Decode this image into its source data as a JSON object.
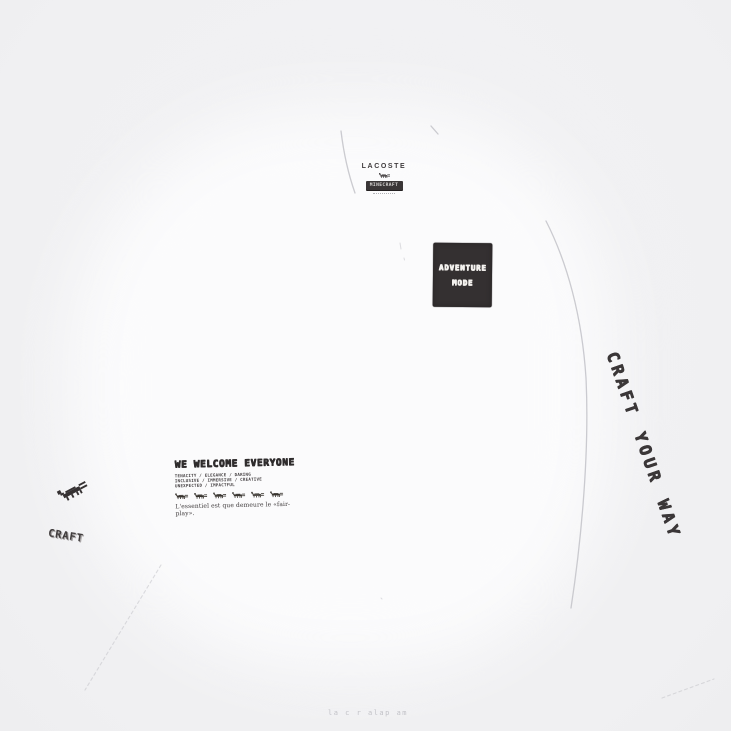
{
  "scene": {
    "background_color": "#f1f1f3",
    "shirt_color": "#fbfbfc",
    "ink_color": "#373334",
    "seam_color": "#c3c3c9"
  },
  "brand_lockup": {
    "wordmark": "LACOSTE",
    "collab_logo": "MINECRAFT"
  },
  "adventure_patch": {
    "line1": "ADVENTURE",
    "line2": "MODE",
    "bg_color": "#343031",
    "text_color": "#f4f2ef"
  },
  "side_print": {
    "text": "CRAFT YOUR WAY"
  },
  "chest_print": {
    "title": "WE WELCOME EVERYONE",
    "values": [
      "TENACITY / ELEGANCE / DARING",
      "INCLUSIVE / IMMERSIVE / CREATIVE",
      "UNEXPECTED / IMPACTFUL"
    ],
    "croc_count": 6,
    "tagline": "L'essentiel est que demeure le «fair-play»."
  },
  "sleeve_print": {
    "logo": "CRAFT"
  },
  "watermark": "la c r alap am"
}
